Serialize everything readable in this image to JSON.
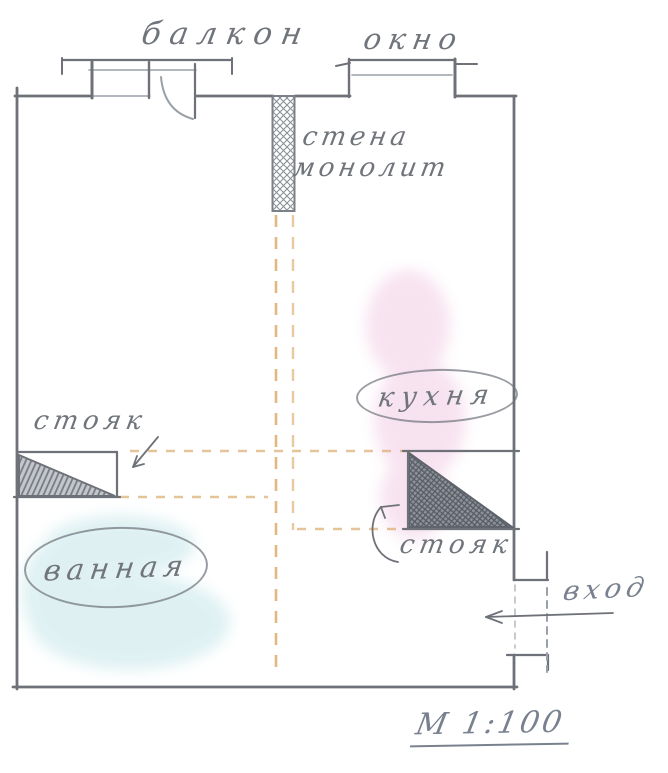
{
  "drawing": {
    "title_note": "hand-drawn apartment floor plan sketch",
    "labels": {
      "balcony": "балкон",
      "window": "окно",
      "wall_monolith_line1": "стена",
      "wall_monolith_line2": "монолит",
      "kitchen": "кухня",
      "riser_left": "стояк",
      "bathroom": "ванная",
      "riser_right": "стояк",
      "entrance": "вход",
      "scale": "М 1:100"
    },
    "colors": {
      "pencil": "#6e7178",
      "pencil_light": "#9aa0a8",
      "pencil_text": "#70747b",
      "plan_dash_orange": "#d9a563",
      "kitchen_pink": "#eec2de",
      "bathroom_cyan": "#bfe3e6",
      "ink_blue_gray": "#79818f"
    }
  }
}
